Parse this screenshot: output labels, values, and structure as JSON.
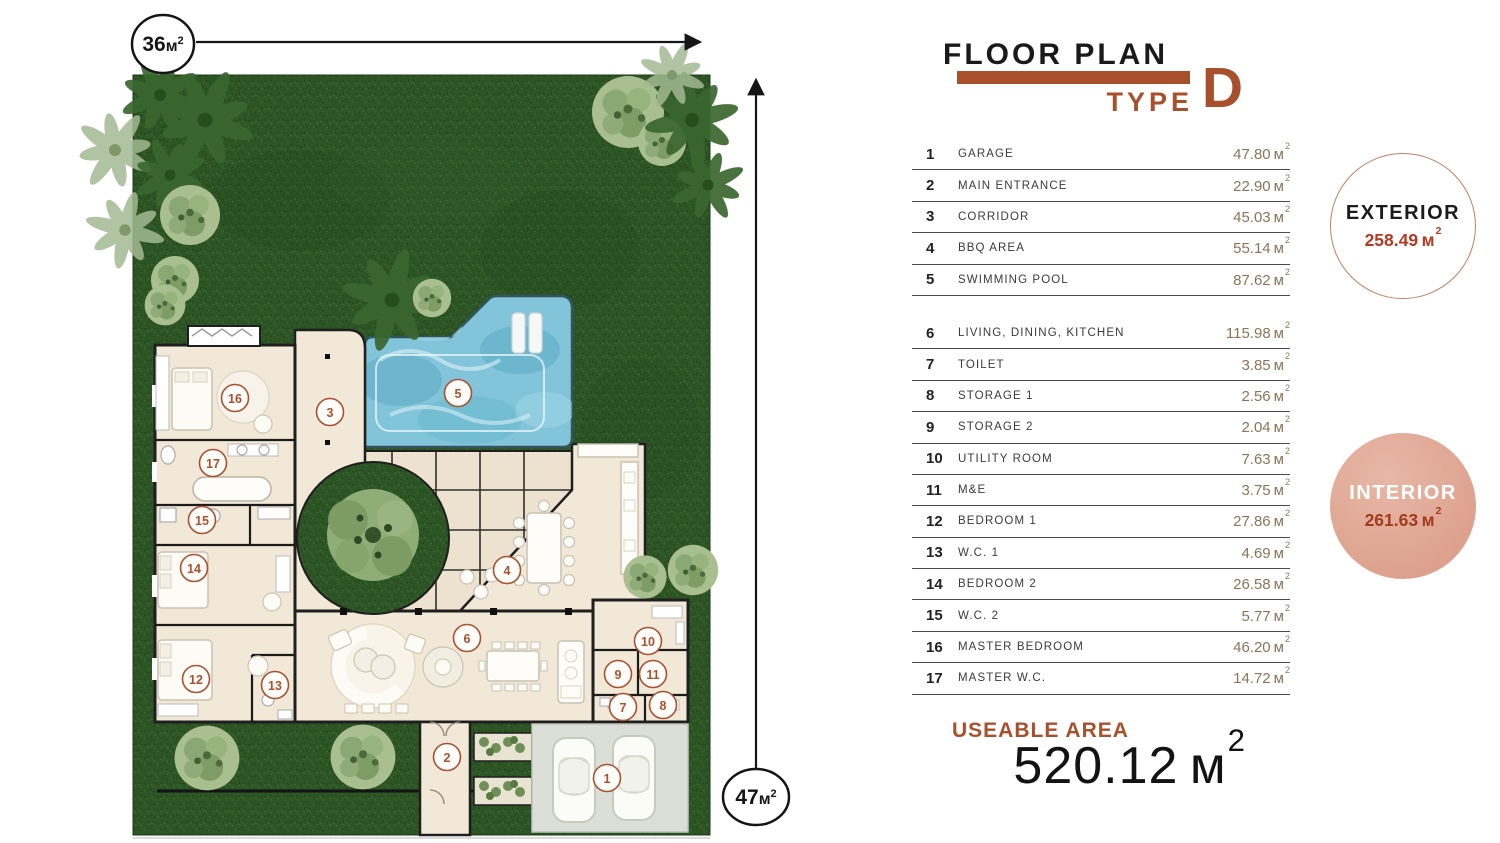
{
  "title": {
    "main": "FLOOR PLAN",
    "type_label": "TYPE",
    "type_letter": "D"
  },
  "legend": {
    "unit": "м",
    "unit_sup": "2",
    "groups": [
      {
        "rows": [
          {
            "num": "1",
            "name": "GARAGE",
            "area": "47.80"
          },
          {
            "num": "2",
            "name": "MAIN ENTRANCE",
            "area": "22.90"
          },
          {
            "num": "3",
            "name": "CORRIDOR",
            "area": "45.03"
          },
          {
            "num": "4",
            "name": "BBQ AREA",
            "area": "55.14"
          },
          {
            "num": "5",
            "name": "SWIMMING POOL",
            "area": "87.62"
          }
        ]
      },
      {
        "rows": [
          {
            "num": "6",
            "name": "LIVING, DINING, KITCHEN",
            "area": "115.98"
          },
          {
            "num": "7",
            "name": "TOILET",
            "area": "3.85"
          },
          {
            "num": "8",
            "name": "STORAGE 1",
            "area": "2.56"
          },
          {
            "num": "9",
            "name": "STORAGE 2",
            "area": "2.04"
          },
          {
            "num": "10",
            "name": "UTILITY ROOM",
            "area": "7.63"
          },
          {
            "num": "11",
            "name": "M&E",
            "area": "3.75"
          },
          {
            "num": "12",
            "name": "BEDROOM 1",
            "area": "27.86"
          },
          {
            "num": "13",
            "name": "W.C. 1",
            "area": "4.69"
          },
          {
            "num": "14",
            "name": "BEDROOM 2",
            "area": "26.58"
          },
          {
            "num": "15",
            "name": "W.C. 2",
            "area": "5.77"
          },
          {
            "num": "16",
            "name": "MASTER BEDROOM",
            "area": "46.20"
          },
          {
            "num": "17",
            "name": "MASTER W.C.",
            "area": "14.72"
          }
        ]
      }
    ]
  },
  "areas": {
    "exterior": {
      "label": "EXTERIOR",
      "value": "258.49"
    },
    "interior": {
      "label": "INTERIOR",
      "value": "261.63"
    },
    "unit": "м",
    "unit_sup": "2"
  },
  "summary": {
    "label": "USEABLE AREA",
    "value": "520.12",
    "unit": "м",
    "unit_sup": "2"
  },
  "dimensions": {
    "width": "36",
    "height": "47",
    "unit": "м",
    "unit_sup": "2"
  },
  "plan": {
    "rooms": [
      {
        "n": "1",
        "x": 607,
        "y": 778
      },
      {
        "n": "2",
        "x": 447,
        "y": 757
      },
      {
        "n": "3",
        "x": 330,
        "y": 412
      },
      {
        "n": "4",
        "x": 507,
        "y": 570
      },
      {
        "n": "5",
        "x": 458,
        "y": 393
      },
      {
        "n": "6",
        "x": 467,
        "y": 638
      },
      {
        "n": "7",
        "x": 623,
        "y": 707
      },
      {
        "n": "8",
        "x": 663,
        "y": 705
      },
      {
        "n": "9",
        "x": 618,
        "y": 674
      },
      {
        "n": "10",
        "x": 648,
        "y": 641
      },
      {
        "n": "11",
        "x": 653,
        "y": 674
      },
      {
        "n": "12",
        "x": 196,
        "y": 679
      },
      {
        "n": "13",
        "x": 275,
        "y": 685
      },
      {
        "n": "14",
        "x": 194,
        "y": 568
      },
      {
        "n": "15",
        "x": 202,
        "y": 520
      },
      {
        "n": "16",
        "x": 235,
        "y": 398
      },
      {
        "n": "17",
        "x": 213,
        "y": 463
      }
    ]
  },
  "colors": {
    "accent": "#a8502c",
    "area_value": "#8a7457",
    "red_value": "#b23a22",
    "interior_fill": "#dfa492",
    "lawn": "#2d5526",
    "pool_water": "#82c4d9",
    "floor_cream": "#f1e8d7",
    "wall": "#1f1f1f"
  }
}
